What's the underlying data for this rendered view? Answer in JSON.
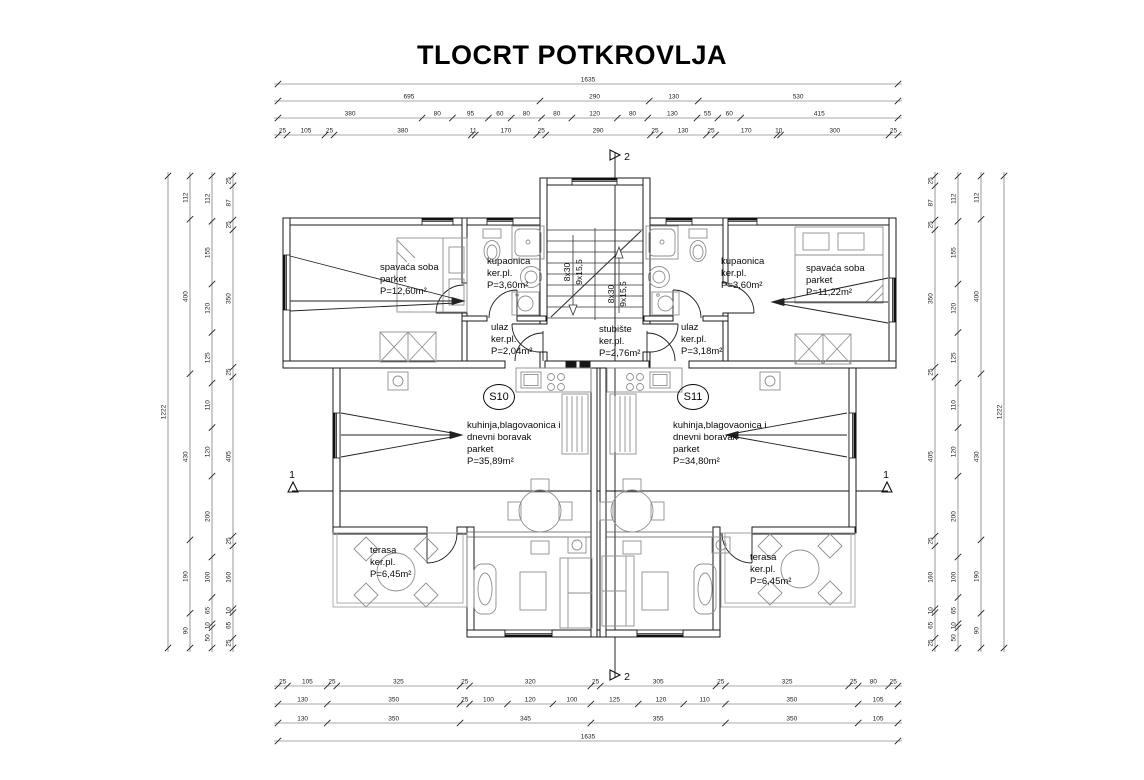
{
  "title": "TLOCRT POTKROVLJA",
  "units": [
    {
      "label": "S10"
    },
    {
      "label": "S11"
    }
  ],
  "rooms": [
    {
      "id": "bedroom-left",
      "label": "spavaća soba\nparket\nP=12,60m²"
    },
    {
      "id": "bathroom-left",
      "label": "kupaonica\nker.pl.\nP=3,60m²"
    },
    {
      "id": "entry-left",
      "label": "ulaz\nker.pl.\nP=2,04m²"
    },
    {
      "id": "staircase",
      "label": "stubište\nker.pl.\nP=2,76m²"
    },
    {
      "id": "entry-right",
      "label": "ulaz\nker.pl.\nP=3,18m²"
    },
    {
      "id": "bathroom-right",
      "label": "kupaonica\nker.pl.\nP=3,60m²"
    },
    {
      "id": "bedroom-right",
      "label": "spavaća soba\nparket\nP=11,22m²"
    },
    {
      "id": "living-left",
      "label": "kuhinja,blagovaonica i\ndnevni boravak\nparket\nP=35,89m²"
    },
    {
      "id": "living-right",
      "label": "kuhinja,blagovaonica i\ndnevni boravak\nparket\nP=34,80m²"
    },
    {
      "id": "terrace-left",
      "label": "terasa\nker.pl.\nP=6,45m²"
    },
    {
      "id": "terrace-right",
      "label": "terasa\nker.pl.\nP=6,45m²"
    }
  ],
  "stair_labels": {
    "left_flight": [
      "8x30",
      "9x15,5"
    ],
    "right_flight": [
      "8x30",
      "9x15,5"
    ]
  },
  "section_markers": {
    "vertical": "2",
    "horizontal": "1"
  },
  "dimensions": {
    "top": {
      "rows": [
        [
          1635
        ],
        [
          695,
          290,
          130,
          530
        ],
        [
          380,
          80,
          95,
          60,
          80,
          80,
          120,
          80,
          130,
          55,
          60,
          415
        ],
        [
          25,
          105,
          25,
          380,
          11,
          170,
          25,
          290,
          25,
          130,
          25,
          170,
          10,
          300,
          25
        ]
      ]
    },
    "bottom": {
      "rows": [
        [
          25,
          105,
          25,
          325,
          25,
          320,
          25,
          305,
          25,
          325,
          25,
          80,
          25
        ],
        [
          130,
          350,
          25,
          100,
          120,
          100,
          125,
          120,
          110,
          350,
          105
        ],
        [
          130,
          350,
          345,
          355,
          350,
          105
        ],
        [
          1635
        ]
      ]
    },
    "left": {
      "cols": [
        [
          1222
        ],
        [
          112,
          400,
          430,
          190,
          90
        ],
        [
          112,
          155,
          120,
          125,
          110,
          120,
          200,
          100,
          65,
          10,
          50
        ],
        [
          25,
          87,
          25,
          350,
          25,
          405,
          25,
          160,
          10,
          65,
          25
        ]
      ]
    },
    "right": {
      "cols": [
        [
          25,
          87,
          25,
          350,
          25,
          405,
          25,
          160,
          10,
          65,
          25
        ],
        [
          112,
          155,
          120,
          125,
          110,
          120,
          200,
          100,
          65,
          10,
          50
        ],
        [
          112,
          400,
          430,
          190,
          90
        ],
        [
          1222
        ]
      ]
    }
  }
}
